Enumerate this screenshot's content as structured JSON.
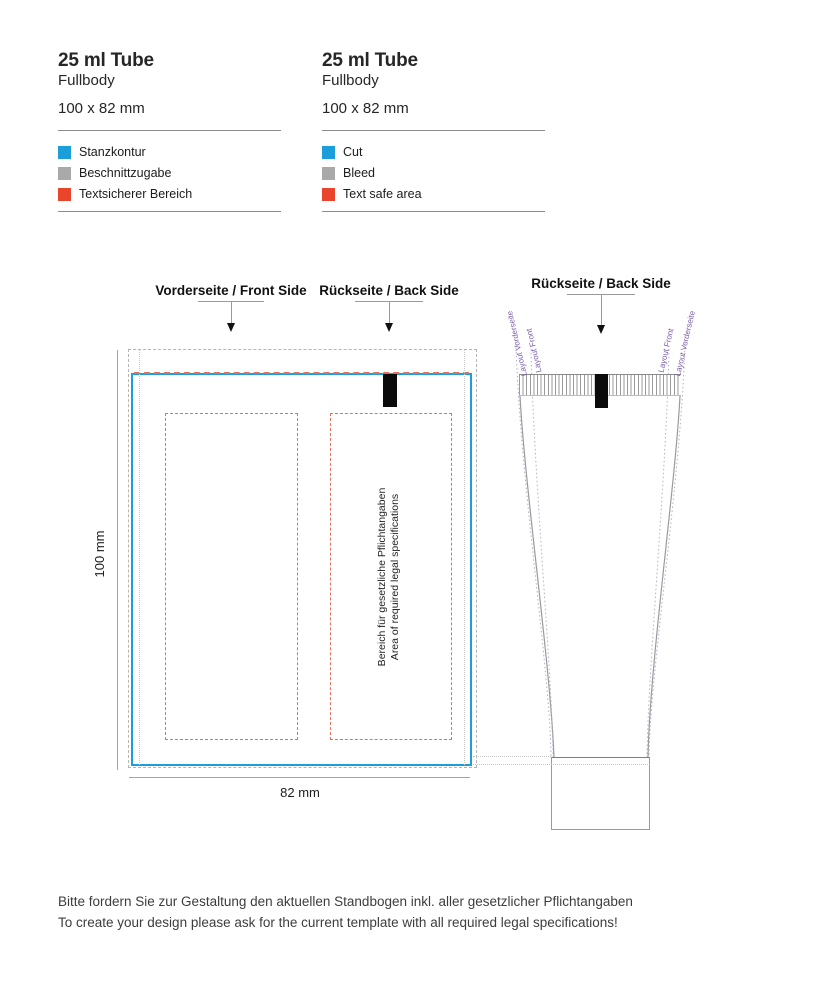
{
  "colors": {
    "cut": "#1b9ed9",
    "bleed": "#a9a9a9",
    "text_safe": "#e8452c",
    "safe_dash_line": "#e4705a",
    "guide_purple": "#7b5ea7"
  },
  "legend_blocks": [
    {
      "title": "25 ml Tube",
      "subtitle": "Fullbody",
      "size": "100 x 82 mm",
      "items": [
        {
          "label": "Stanzkontur",
          "color": "#1b9ed9"
        },
        {
          "label": "Beschnittzugabe",
          "color": "#a9a9a9"
        },
        {
          "label": "Textsicherer Bereich",
          "color": "#e8452c"
        }
      ]
    },
    {
      "title": "25 ml Tube",
      "subtitle": "Fullbody",
      "size": "100 x 82 mm",
      "items": [
        {
          "label": "Cut",
          "color": "#1b9ed9"
        },
        {
          "label": "Bleed",
          "color": "#a9a9a9"
        },
        {
          "label": "Text safe area",
          "color": "#e8452c"
        }
      ]
    }
  ],
  "dieline": {
    "front_pointer": "Vorderseite / Front Side",
    "back_pointer": "Rückseite / Back Side",
    "height_label": "100 mm",
    "width_label": "82 mm",
    "legal_text_de": "Bereich für gesetzliche Pflichtangaben",
    "legal_text_en": "Area of required legal specifications"
  },
  "tube": {
    "pointer": "Rückseite / Back Side",
    "guide_left_outer": "Layout Vorderseite",
    "guide_left_inner": "Layout Front",
    "guide_right_inner": "Layout Front",
    "guide_right_outer": "Layout Vorderseite"
  },
  "footer": {
    "line1_de": "Bitte fordern Sie zur Gestaltung den aktuellen Standbogen inkl. aller gesetzlicher Pflichtangaben",
    "line2_en": "To create your design please ask for the current template with all required legal specifications!"
  }
}
